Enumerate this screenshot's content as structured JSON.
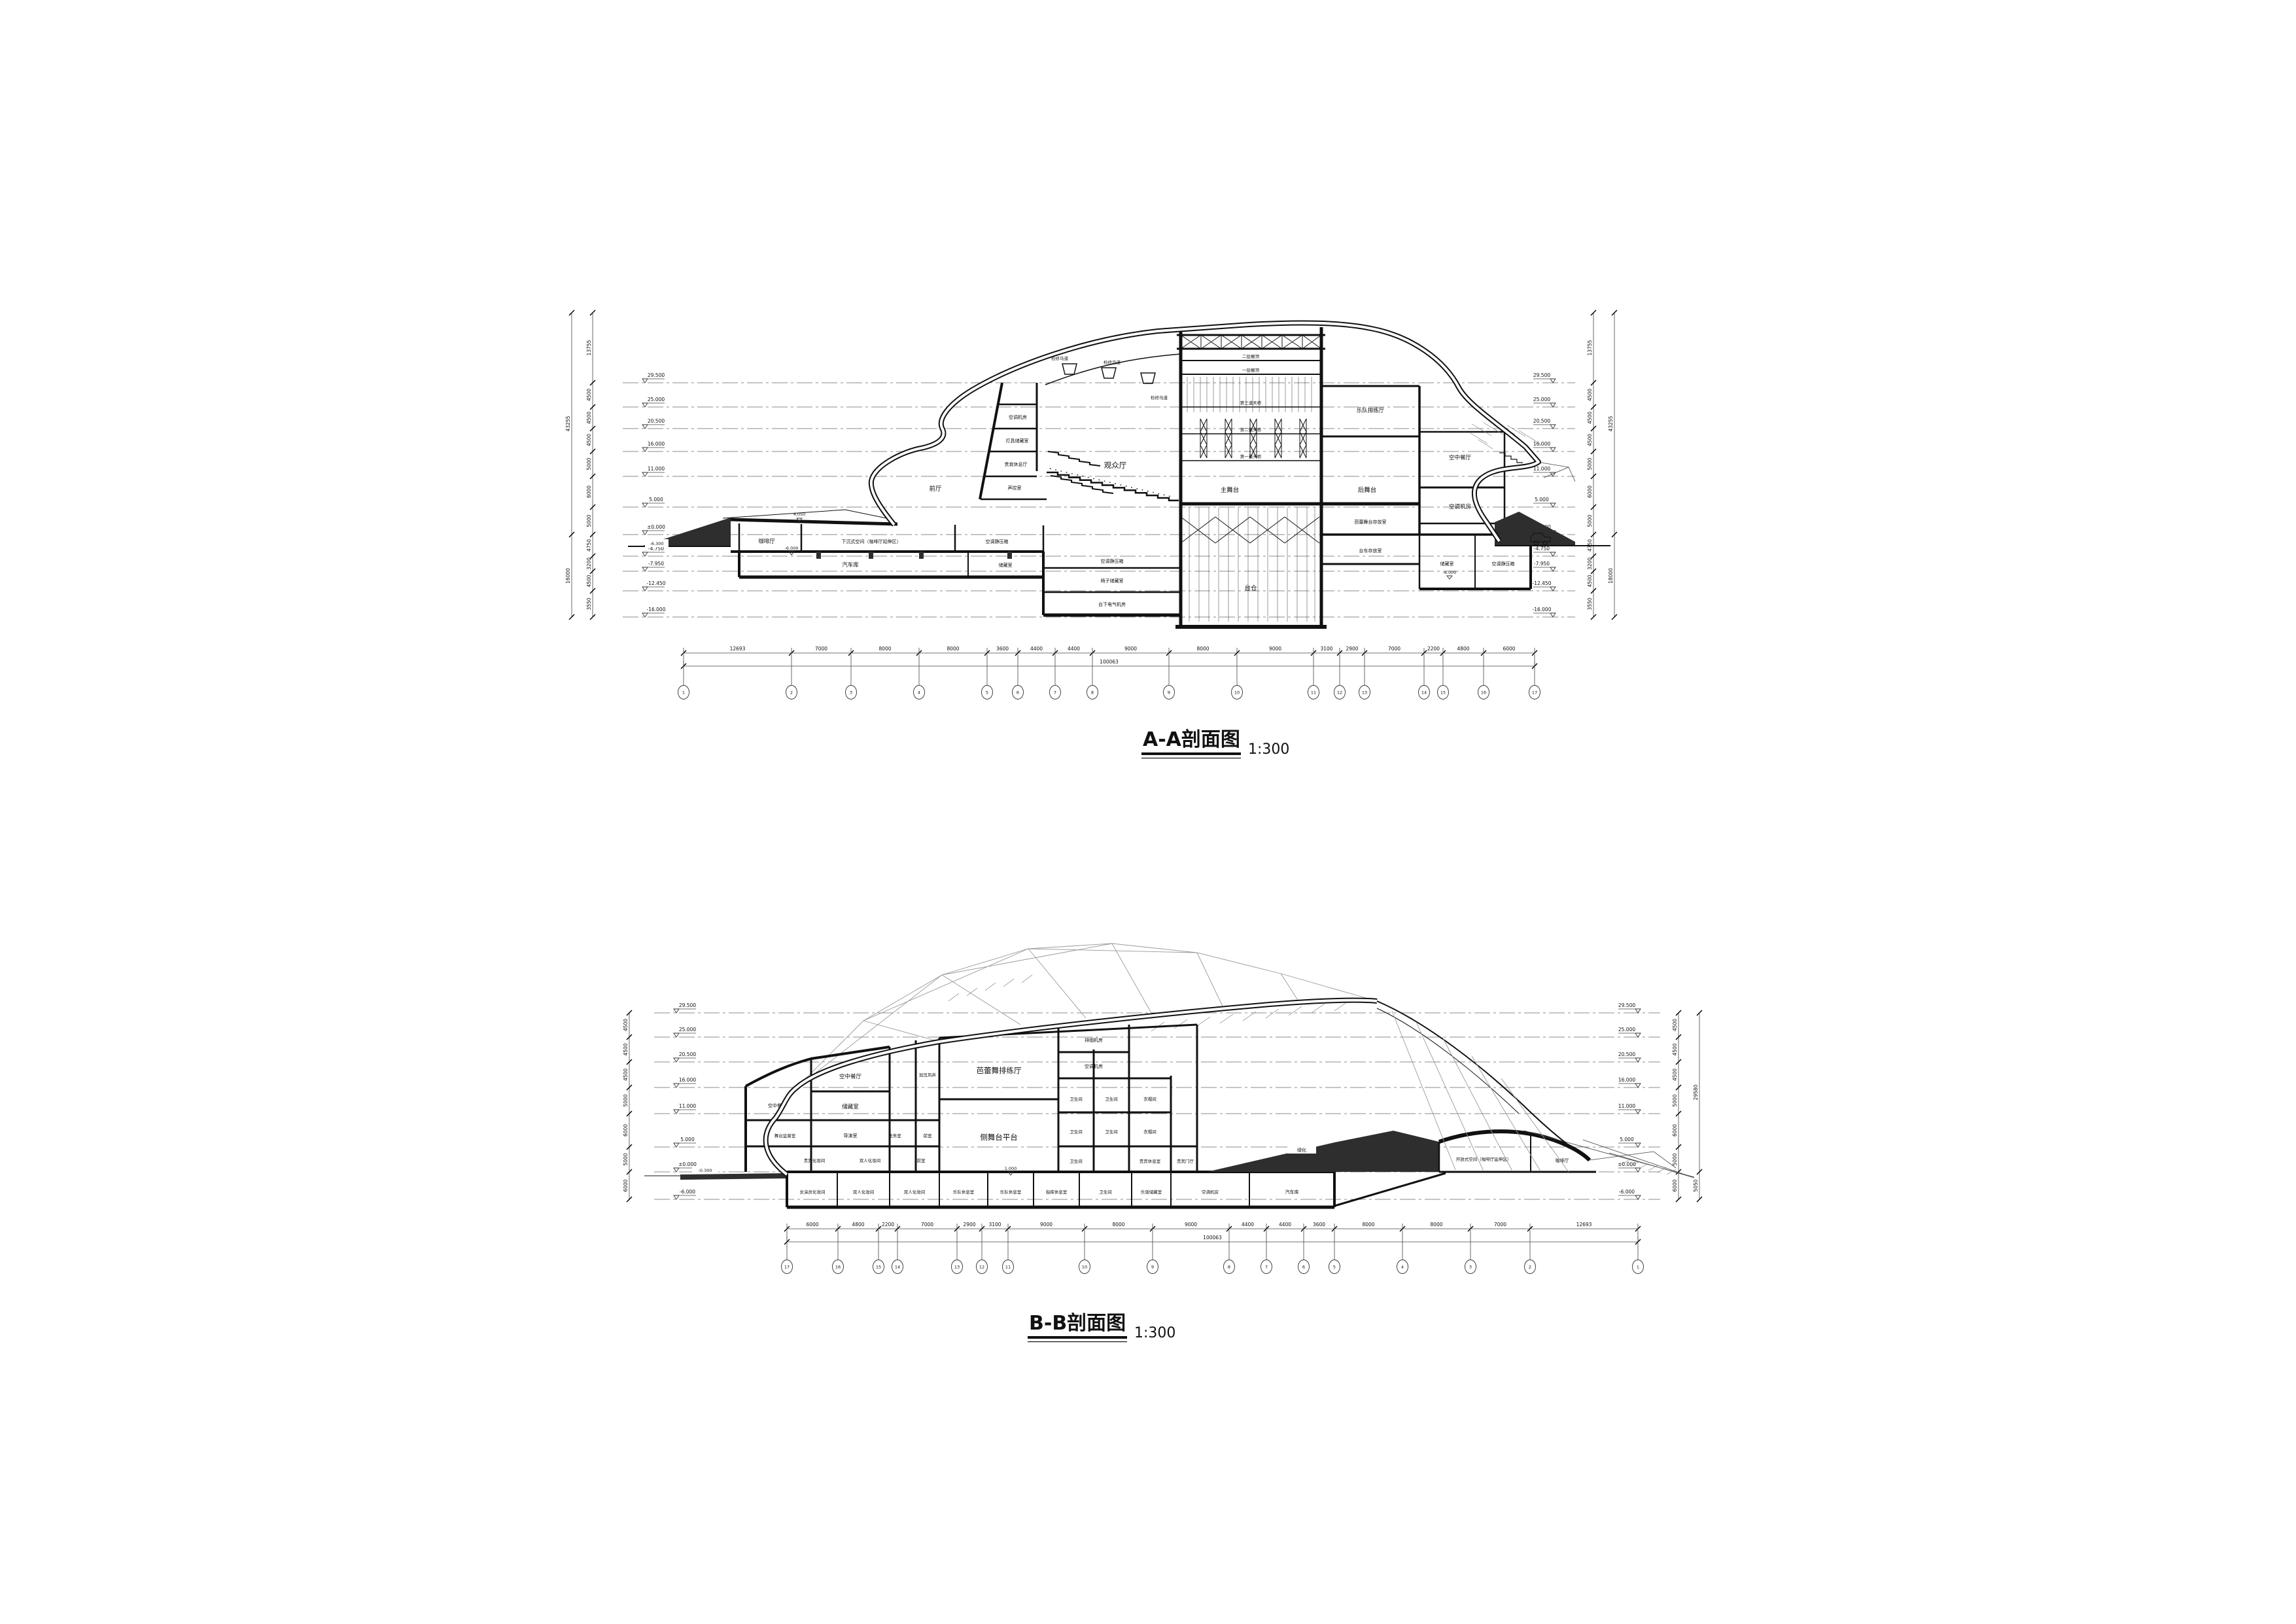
{
  "sheet": {
    "background": "#ffffff",
    "line_color": "#111111",
    "poche_color": "#2e2e2e"
  },
  "aa": {
    "title": "A-A剖面图",
    "scale": "1:300",
    "levels": [
      "29.500",
      "25.000",
      "20.500",
      "16.000",
      "11.000",
      "5.000",
      "±0.000",
      "-4.750",
      "-7.950",
      "-12.450",
      "-16.000"
    ],
    "chain_dims": [
      "13755",
      "4500",
      "4500",
      "4500",
      "5000",
      "6000",
      "5000",
      "4750",
      "3200",
      "4500",
      "3550"
    ],
    "chain_totals_left": [
      "43255",
      "16000"
    ],
    "chain_totals_right": [
      "43255",
      "18000"
    ],
    "bottom_dims": [
      "12693",
      "7000",
      "8000",
      "8000",
      "3600",
      "4400",
      "4400",
      "9000",
      "8000",
      "9000",
      "3100",
      "2900",
      "7000",
      "2200",
      "4800",
      "6000"
    ],
    "bottom_total": [
      "100063"
    ],
    "grids": [
      "1",
      "2",
      "3",
      "4",
      "5",
      "6",
      "7",
      "8",
      "9",
      "10",
      "11",
      "12",
      "13",
      "14",
      "15",
      "16",
      "17"
    ],
    "marks": {
      "street": "-6.300",
      "mound": "4.050",
      "minus6": "-6.000"
    },
    "rooms": {
      "cafe": "咖啡厅",
      "sunken": "下沉式空间（咖啡厅延伸区）",
      "plenum": "空调静压箱",
      "garage": "汽车库",
      "storage": "储藏室",
      "chair": "椅子储藏室",
      "elec": "台下电气机房",
      "ahu": "空调机房",
      "lamp": "灯具储藏室",
      "vip": "贵宾休息厅",
      "sound": "声控室",
      "foyer": "前厅",
      "aud": "观众厅",
      "catwalk": "检修马道",
      "grid2": "二层栅顶",
      "grid1": "一层栅顶",
      "br3": "第三道天桥",
      "br2": "第二道天桥",
      "br1": "第一道天桥",
      "stage": "主舞台",
      "rear": "后舞台",
      "pit": "台仓",
      "ballet": "芭蕾舞台存放室",
      "trolley": "台车存放室",
      "orch": "乐队排练厅",
      "rest": "空中餐厅",
      "ahu2": "空调机房"
    }
  },
  "bb": {
    "title": "B-B剖面图",
    "scale": "1:300",
    "levels": [
      "29.500",
      "25.000",
      "20.500",
      "16.000",
      "11.000",
      "5.000",
      "±0.000",
      "-6.000"
    ],
    "chain_dims": [
      "4500",
      "4500",
      "4500",
      "5000",
      "6000",
      "5000",
      "6000"
    ],
    "chain_totals": [
      "29580",
      "5050"
    ],
    "bottom_dims": [
      "6000",
      "4800",
      "2200",
      "7000",
      "2900",
      "3100",
      "9000",
      "8000",
      "9000",
      "4400",
      "4400",
      "3600",
      "8000",
      "8000",
      "7000",
      "12693"
    ],
    "bottom_total": [
      "100063"
    ],
    "grids": [
      "17",
      "16",
      "15",
      "14",
      "13",
      "12",
      "11",
      "10",
      "9",
      "8",
      "7",
      "6",
      "5",
      "4",
      "3",
      "2",
      "1"
    ],
    "marks": {
      "street": "-0.300",
      "one": "1.000",
      "green": "绿化"
    },
    "rooms": {
      "smoke": "排烟机房",
      "ahu_top": "空调机房",
      "ballet": "芭蕾舞排练厅",
      "side": "侧舞台平台",
      "wc": "卫生间",
      "cloak": "衣帽间",
      "viprest": "贵宾休息室",
      "viphall": "贵宾门厅",
      "sky": "空中餐厅",
      "storage": "储藏室",
      "mgr": "舞台监督室",
      "dir": "导演室",
      "med": "医务室",
      "ante": "前室",
      "shaft": "加压风井",
      "vipdress": "贵宾化妆间",
      "dbldress": "双人化妆间",
      "actress": "女演员化妆间",
      "band": "乐队休息室",
      "conductor": "指挥休息室",
      "score": "乐谱储藏室",
      "open": "开放式空间（咖啡厅延伸区）",
      "cafe": "咖啡厅",
      "ahu_b": "空调机房",
      "garage": "汽车库"
    }
  }
}
